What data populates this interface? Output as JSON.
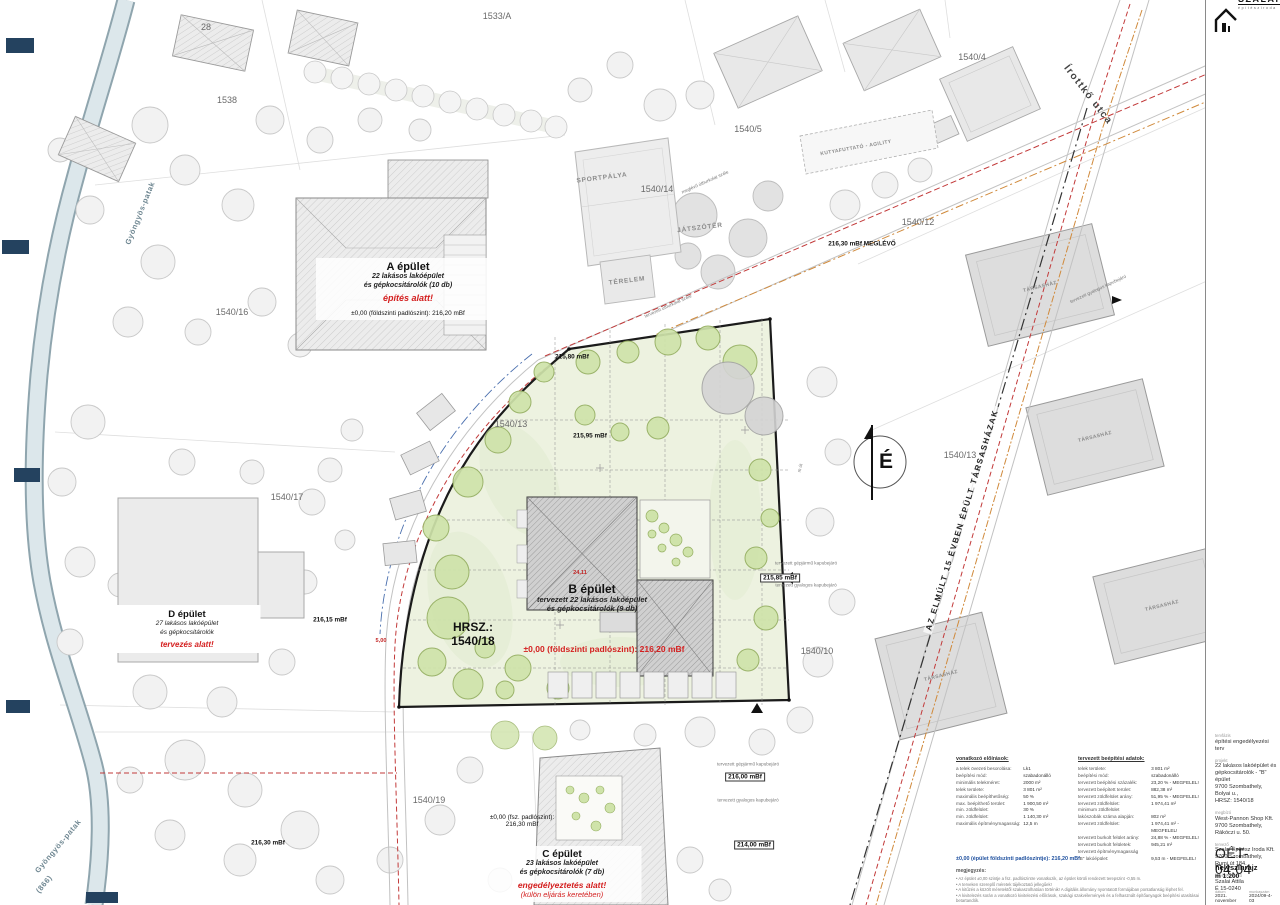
{
  "logo": {
    "brand": "SZALAI",
    "tagline": "építésziroda"
  },
  "north_label": "É",
  "street_name": "Írottkő utca",
  "diagonal_note": "AZ ELMÚLT 15 ÉVBEN ÉPÜLT TÁRSASHÁZAK",
  "hrsz": {
    "line1": "HRSZ.:",
    "line2": "1540/18"
  },
  "parcel_labels": [
    {
      "t": "1533/A",
      "x": 497,
      "y": 16
    },
    {
      "t": "28",
      "x": 206,
      "y": 27
    },
    {
      "t": "1538",
      "x": 227,
      "y": 100
    },
    {
      "t": "1540/4",
      "x": 972,
      "y": 57
    },
    {
      "t": "1540/5",
      "x": 748,
      "y": 129
    },
    {
      "t": "1540/14",
      "x": 657,
      "y": 189
    },
    {
      "t": "1540/12",
      "x": 918,
      "y": 222
    },
    {
      "t": "1540/16",
      "x": 232,
      "y": 312
    },
    {
      "t": "1540/13",
      "x": 511,
      "y": 424
    },
    {
      "t": "1540/13",
      "x": 960,
      "y": 455
    },
    {
      "t": "1540/17",
      "x": 287,
      "y": 497
    },
    {
      "t": "1540/10",
      "x": 817,
      "y": 651
    },
    {
      "t": "1540/19",
      "x": 429,
      "y": 800
    }
  ],
  "area_labels": [
    {
      "t": "SPORTPÁLYA",
      "x": 602,
      "y": 178,
      "r": -7
    },
    {
      "t": "JÁTSZÓTÉR",
      "x": 700,
      "y": 228,
      "r": -7
    },
    {
      "t": "TÉRELEM",
      "x": 627,
      "y": 281,
      "r": -7
    },
    {
      "t": "KUTYAFUTTATÓ - AGILITY",
      "x": 856,
      "y": 148,
      "r": -10,
      "c": "smaller"
    },
    {
      "t": "TÁRSASHÁZ",
      "x": 1040,
      "y": 287,
      "r": -14,
      "c": "smaller"
    },
    {
      "t": "TÁRSASHÁZ",
      "x": 1095,
      "y": 437,
      "r": -14,
      "c": "smaller"
    },
    {
      "t": "TÁRSASHÁZ",
      "x": 1162,
      "y": 606,
      "r": -14,
      "c": "smaller"
    },
    {
      "t": "TÁRSASHÁZ",
      "x": 941,
      "y": 676,
      "r": -14,
      "c": "smaller"
    },
    {
      "t": "Gyöngyös-patak",
      "x": 140,
      "y": 213,
      "r": -68,
      "c": "stream"
    },
    {
      "t": "Gyöngyös-patak",
      "x": 58,
      "y": 846,
      "r": -50,
      "c": "stream"
    },
    {
      "t": "(866)",
      "x": 44,
      "y": 884,
      "r": -50,
      "c": "stream"
    }
  ],
  "point_labels": [
    {
      "t": "216,15 mBf",
      "x": 330,
      "y": 620,
      "c": "elev"
    },
    {
      "t": "216,30 mBf",
      "x": 268,
      "y": 843,
      "c": "elev"
    },
    {
      "t": "215,80 mBf",
      "x": 572,
      "y": 357,
      "c": "elev"
    },
    {
      "t": "215,95 mBf",
      "x": 590,
      "y": 436,
      "c": "elev"
    },
    {
      "t": "216,30 mBf MEGLÉVŐ",
      "x": 862,
      "y": 244,
      "c": "elev"
    },
    {
      "t": "215,85 mBf",
      "x": 780,
      "y": 578,
      "c": "elev box"
    },
    {
      "t": "216,00 mBf",
      "x": 745,
      "y": 777,
      "c": "elev box"
    },
    {
      "t": "214,00 mBf",
      "x": 754,
      "y": 845,
      "c": "elev box"
    },
    {
      "t": "tervezett gépjármű kapubejáró",
      "x": 806,
      "y": 563,
      "c": "tiny"
    },
    {
      "t": "tervezett gyalogos kapubejáró",
      "x": 806,
      "y": 585,
      "c": "tiny"
    },
    {
      "t": "tervezett gépjármű kapubejáró",
      "x": 748,
      "y": 764,
      "c": "tiny"
    },
    {
      "t": "tervezett gyalogos kapubejáró",
      "x": 748,
      "y": 800,
      "c": "tiny"
    },
    {
      "t": "tervezett gyalogos kapubejáró",
      "x": 1098,
      "y": 289,
      "r": -25,
      "c": "tiny"
    },
    {
      "t": "tervezett útburkolat széle",
      "x": 668,
      "y": 306,
      "r": -24,
      "c": "tiny"
    },
    {
      "t": "meglévő útburkolat széle",
      "x": 705,
      "y": 182,
      "r": -24,
      "c": "tiny"
    },
    {
      "t": "m út",
      "x": 800,
      "y": 468,
      "r": -78,
      "c": "tiny"
    },
    {
      "t": "5,00",
      "x": 381,
      "y": 641,
      "c": "dim"
    },
    {
      "t": "24,11",
      "x": 580,
      "y": 573,
      "c": "dim"
    }
  ],
  "buildings": {
    "a": {
      "title": "A épület",
      "desc1": "22 lakásos lakóépület",
      "desc2": "és gépkocsitárolók (10 db)",
      "status": "építés alatt!",
      "elevation": "±0,00 (földszinti padlószint): 216,20 mBf"
    },
    "b": {
      "title": "B épület",
      "desc1": "tervezett 22 lakásos lakóépület",
      "desc2": "és gépkocsitárolók (9 db)",
      "elevation": "±0,00 (földszinti padlószint): 216,20 mBf"
    },
    "c": {
      "elev1": "±0,00 (fsz. padlószint):",
      "elev2": "216,30 mBf",
      "title": "C épület",
      "desc1": "23 lakásos lakóépület",
      "desc2": "és gépkocsitárolók (7 db)",
      "status": "engedélyeztetés alatt!",
      "status2": "(külön eljárás keretében)"
    },
    "d": {
      "title": "D épület",
      "desc1": "27 lakásos lakóépület",
      "desc2": "és gépkocsitárolók",
      "status": "tervezés alatt!"
    }
  },
  "regulations": {
    "title": "vonatkozó előírások:",
    "rows": [
      {
        "label": "a telek övezeti besorolása:",
        "value": "Lk1"
      },
      {
        "label": "beépítési mód:",
        "value": "szabadonálló"
      },
      {
        "label": "minimális telekméret:",
        "value": "2000 m²"
      },
      {
        "label": "telek területe:",
        "value": "3 801 m²"
      },
      {
        "label": "maximális beépíthetőség:",
        "value": "50 %"
      },
      {
        "label": "max. beépíthető terület:",
        "value": "1 900,50 m²"
      },
      {
        "label": "min. zöldfelület:",
        "value": "30 %"
      },
      {
        "label": "min. zöldfelület:",
        "value": "1 140,30 m²"
      },
      {
        "label": "maximális építménymagasság:",
        "value": "12,5 m"
      }
    ]
  },
  "planned": {
    "title": "tervezett beépítési adatok:",
    "rows": [
      {
        "label": "telek területe:",
        "value": "3 801 m²"
      },
      {
        "label": "beépítési mód:",
        "value": "szabadonálló"
      },
      {
        "label": "tervezett beépítési százalék:",
        "value": "23,20 % - MEGFELEL!"
      },
      {
        "label": "tervezett beépített terület:",
        "value": "882,38 m²"
      },
      {
        "label": "tervezett zöldfelület arány:",
        "value": "51,95 % - MEGFELEL!"
      },
      {
        "label": "tervezett zöldfelület:",
        "value": "1 974,41 m²"
      },
      {
        "label": "minimum zöldfelület",
        "value": ""
      },
      {
        "label": "lakószobák száma alapján:",
        "value": "802 m²"
      },
      {
        "label": "tervezett zöldfelület:",
        "value": "1 974,41 m² - MEGFELEL!"
      },
      {
        "label": "tervezett burkolt felület arány:",
        "value": "24,88 % - MEGFELEL!"
      },
      {
        "label": "tervezett burkolt felületek:",
        "value": "945,21 m²"
      },
      {
        "label": "tervezett építménymagasság",
        "value": ""
      },
      {
        "label": "\"B\" lakóépület:",
        "value": "9,53 m - MEGFELEL!"
      }
    ]
  },
  "floor_note": "±0,00 (épület földszinti padlószintje): 216,20 mBf",
  "notes": {
    "title": "megjegyzés:",
    "items": [
      "Az épület ±0,00 szintje a fsz. padlószintre vonatkozik, az épület körüli rendezett terepszint -0,55 m.",
      "A terveken szereplő méretek tájékoztató jellegűek!",
      "A kitűzés a közölt méretektől szakaszolhatóan történik! A digitális állomány nyomtatott formájában pontatlanság léphet fel.",
      "A kivitelezés során a vonatkozó kivitelezési előírások, szakági szakvélemények és a felhasznált építőanyagok beépítési utasításai betartandók."
    ]
  },
  "titleblock": {
    "fields": [
      {
        "label": "tervfázis",
        "lines": "építési engedélyezési terv"
      },
      {
        "label": "projekt",
        "lines": "22 lakásos lakóépület és\ngépkocsitárolók - \"B\" épület\n9700 Szombathely, Bolyai u.,\nHRSZ: 1540/18"
      },
      {
        "label": "megbízó",
        "lines": "West-Pannon Shop Kft.\n9700 Szombathely,\nRákóczi u. 50."
      },
      {
        "label": "tervező",
        "lines": "Szalai Építész Iroda Kft.\n9700 Szombathely,\nRumi út 184."
      },
      {
        "label": "felelős tervező",
        "lines": "Szalai Attila\nÉ 15-0240"
      }
    ],
    "drawing_number": "OÉT-04.04",
    "drawing_title": "helyszínrajz",
    "scale": "m 1:200",
    "date_label": "dátum",
    "date": "2021. november",
    "worknum_label": "munkaszám",
    "worknum": "2024/09-4-03"
  }
}
